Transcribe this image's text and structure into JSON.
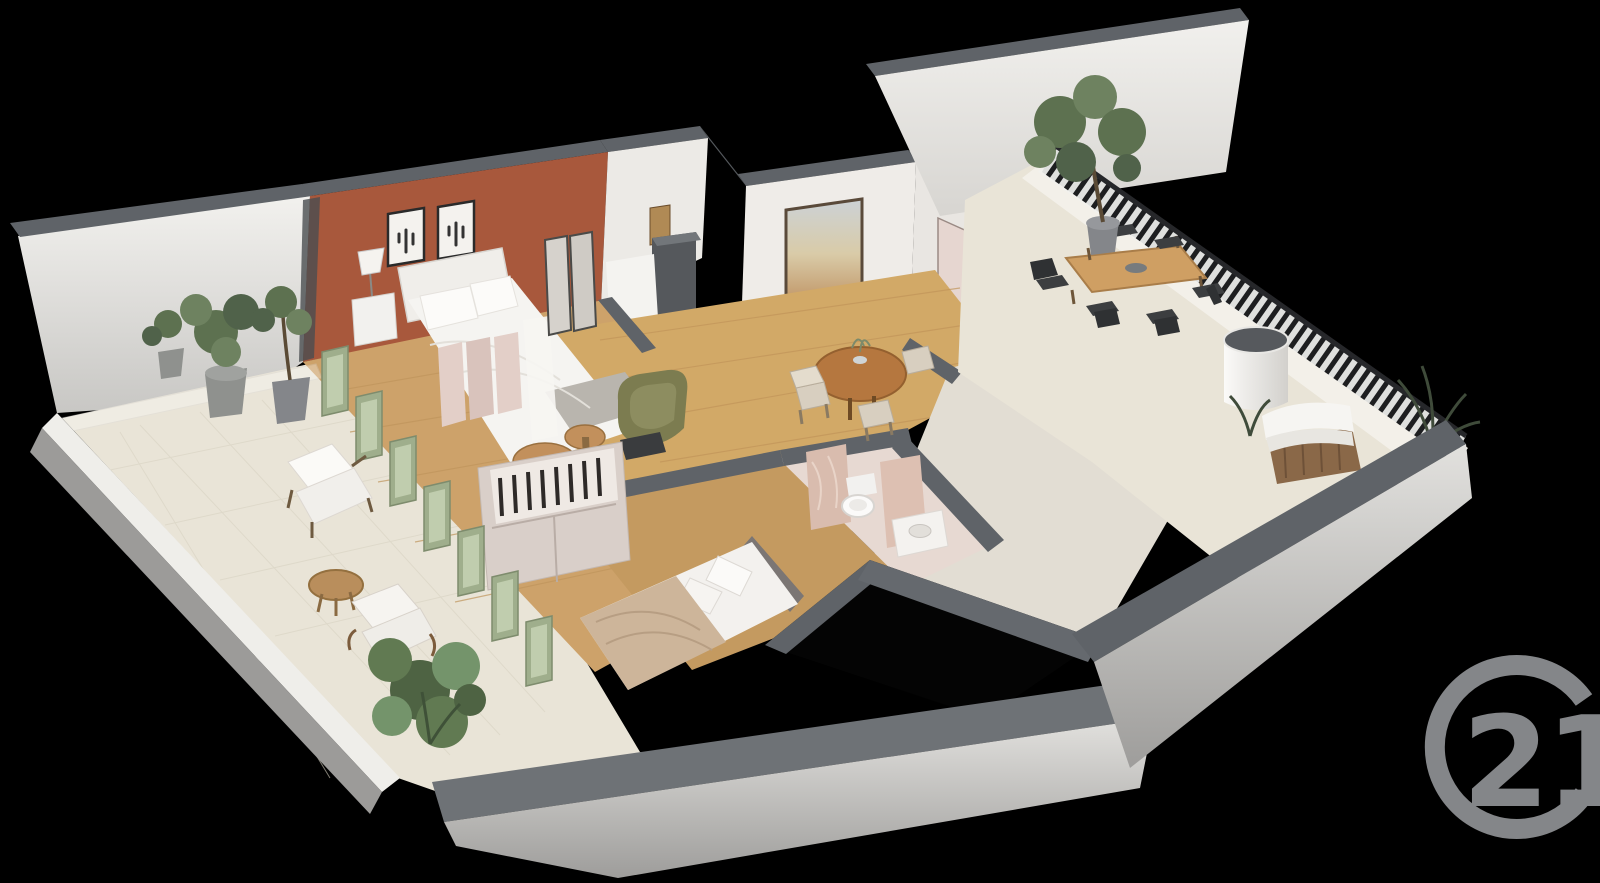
{
  "image": {
    "type": "3d-floor-plan-render",
    "description": "Isometric 3D dollhouse-style floor plan of a two-bedroom apartment with wrap-around terraces rendered on a black background",
    "background_color": "#000000"
  },
  "watermark": {
    "brand": "Century 21",
    "logo_text": "21",
    "logo_color": "#909295",
    "position": "bottom-right"
  },
  "palette": {
    "background": "#000000",
    "wall_top": "#5f6368",
    "wall_face": "#eeedea",
    "wall_shadow": "#b9b8b5",
    "accent_wall": "#a8583c",
    "wood_floor": "#cda26a",
    "tile_floor": "#e9e4d7",
    "sage_green": "#9fae8c",
    "sage_glass": "#c6d2b4",
    "counter_terracotta": "#bf6a44",
    "table_wood": "#c2905c",
    "railing_dark": "#1d1e20",
    "marble_pink": "#d9bcae",
    "plant_green": "#5d7150",
    "plant_dark": "#3f4b3a",
    "olive_chair": "#7c7c50",
    "door_pink": "#e6d6d0",
    "bed_white": "#f5f4f1",
    "logo_gray": "#909295"
  },
  "scene": {
    "rooms": [
      {
        "id": "master-bedroom",
        "features": [
          "terracotta accent wall",
          "two framed cactus prints",
          "double bed with white bedding",
          "white nightstand with lamp",
          "mirrored wardrobe"
        ]
      },
      {
        "id": "dressing-area",
        "features": [
          "open wardrobe with hanging clothes",
          "olive green armchair",
          "two round wooden side tables",
          "pink folding screen"
        ]
      },
      {
        "id": "shower-room",
        "features": [
          "dark shower unit",
          "white counter",
          "wood wall panel"
        ]
      },
      {
        "id": "living-dining-room",
        "features": [
          "round wooden dining table",
          "beige dining chairs",
          "wooden sideboard with books",
          "large framed landscape painting",
          "pink entry door"
        ]
      },
      {
        "id": "kitchen",
        "features": [
          "terracotta countertop",
          "steel sink with faucet",
          "dark cooktop",
          "stand mixer",
          "glazed wall to terrace"
        ]
      },
      {
        "id": "second-bedroom",
        "features": [
          "double bed with beige bedding",
          "wardrobe with open shelving"
        ]
      },
      {
        "id": "bathroom",
        "features": [
          "wall-hung toilet",
          "pink marble partitions",
          "vanity with basin"
        ]
      },
      {
        "id": "left-terrace",
        "features": [
          "potted shrubs",
          "sage green french doors",
          "lounge chairs with white cushions",
          "round coffee table",
          "leafy plant",
          "glass balustrade"
        ]
      },
      {
        "id": "right-terrace",
        "features": [
          "outdoor dining table with dark chairs",
          "potted tree",
          "white cylindrical planter",
          "hot tub with wooden cladding and white cover",
          "black metal railing",
          "dark shrubs"
        ]
      }
    ]
  }
}
